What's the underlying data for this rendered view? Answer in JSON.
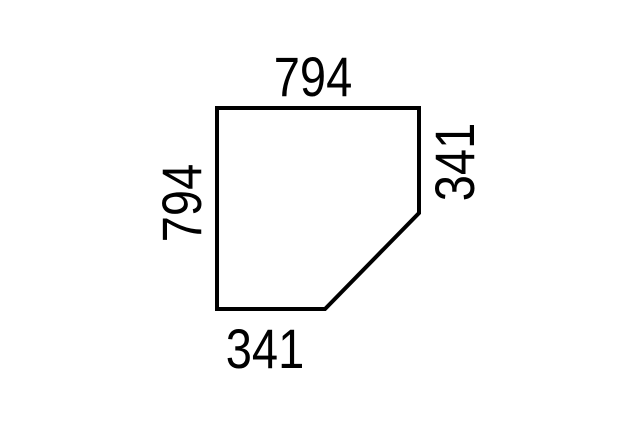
{
  "diagram": {
    "background_color": "#ffffff",
    "outline": {
      "shape": "rectangle-with-clipped-bottom-right-corner",
      "stroke_color": "#000000",
      "stroke_width": 4,
      "fill": "none",
      "points": [
        [
          217,
          108
        ],
        [
          419,
          108
        ],
        [
          419,
          213
        ],
        [
          325,
          309
        ],
        [
          217,
          309
        ]
      ]
    },
    "dimensions": {
      "top": "794",
      "left": "794",
      "right": "341",
      "bottom": "341"
    }
  }
}
